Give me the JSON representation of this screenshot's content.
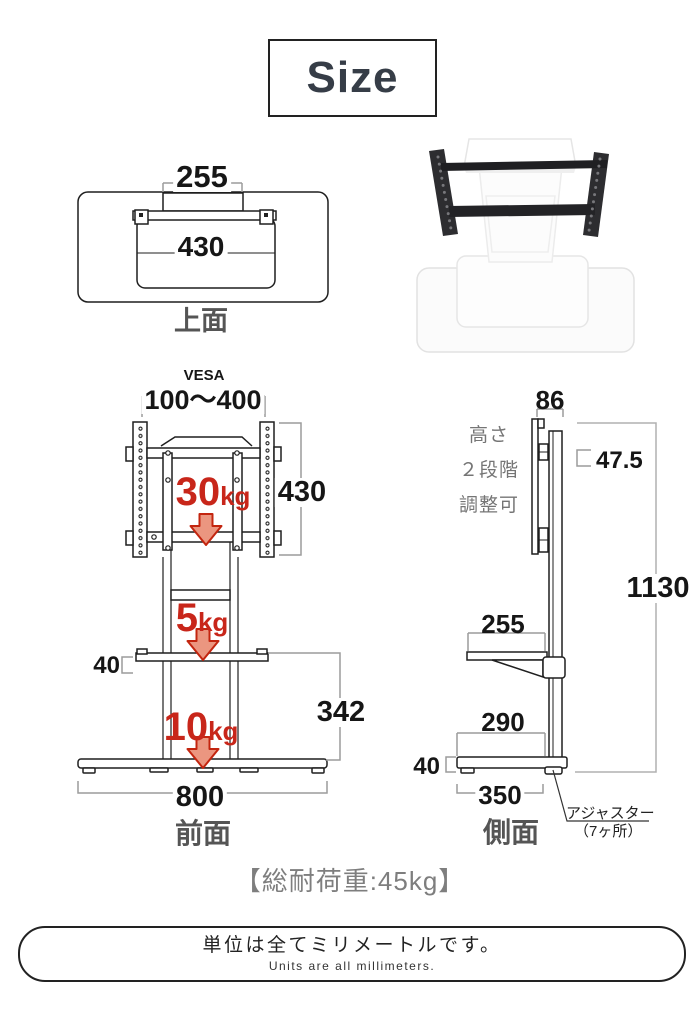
{
  "title": "Size",
  "top_view": {
    "label": "上面",
    "column_width": "255",
    "shelf_width": "430"
  },
  "front_view": {
    "label": "前面",
    "vesa_label": "VESA",
    "vesa_range": "100～400",
    "vesa_height": "430",
    "loads": {
      "top_value": "30",
      "top_unit": "kg",
      "shelf_value": "5",
      "shelf_unit": "kg",
      "base_value": "10",
      "base_unit": "kg"
    },
    "shelf_thickness": "40",
    "shelf_to_floor": "342",
    "base_width": "800"
  },
  "side_view": {
    "label": "側面",
    "depth_top": "86",
    "height_note_line1": "高さ",
    "height_note_line2": "２段階",
    "height_note_line3": "調整可",
    "height_step": "47.5",
    "total_height": "1130",
    "shelf_depth": "255",
    "base_clear_depth": "290",
    "base_thickness": "40",
    "base_depth": "350",
    "adjuster_label": "アジャスター",
    "adjuster_count": "（7ヶ所）"
  },
  "total_load_note": "【総耐荷重:45kg】",
  "footer": {
    "jp": "単位は全てミリメートルです。",
    "en": "Units are all millimeters."
  },
  "colors": {
    "accent_red": "#c8261a",
    "arrow_fill": "#eb9680",
    "ink": "#1f1f1f",
    "dim_line_gray": "#9c9c9c",
    "label_gray": "#555555",
    "note_gray": "#757575"
  }
}
